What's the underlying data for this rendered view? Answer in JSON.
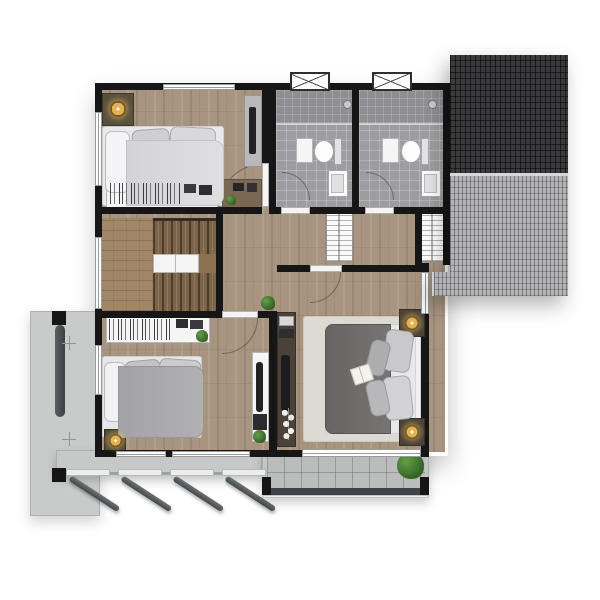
{
  "meta": {
    "type": "architectural-floor-plan",
    "floor": "upper-floor",
    "visible_text": []
  },
  "palette": {
    "wall": "#161616",
    "wood": "#a8947f",
    "bath-tile": "#9d9da1",
    "shower-tile": "#8f8f93",
    "roof-dark": "#3a3a3c",
    "roof-light": "#b2b2b4",
    "concrete": "#c9cbca",
    "balcony-tile": "#babdbc",
    "railing": "#3e4245",
    "stair-wood": "#7c6347",
    "rug": "#dcdad3",
    "duvet-master": "#6f6d6a",
    "duvet-bedroom2": "#ababae",
    "bedding-light": "#e8e8ea",
    "accent-lamp": "#e3b254",
    "plant-green": "#356226"
  },
  "rooms": [
    {
      "id": "bedroom-top-left",
      "furniture": [
        "single-bed",
        "nightstand-with-lamp",
        "dresser-with-books",
        "desk-with-plants",
        "tall-cabinet-with-tv"
      ]
    },
    {
      "id": "bathroom-left",
      "fixtures": [
        "shower-zone",
        "shower-head",
        "toilet",
        "sink",
        "bath-mat",
        "louver-window",
        "door-swing"
      ]
    },
    {
      "id": "bathroom-right",
      "fixtures": [
        "shower-zone",
        "shower-head",
        "toilet",
        "sink",
        "bath-mat",
        "louver-window",
        "door-swing"
      ]
    },
    {
      "id": "staircase",
      "features": [
        "upper-flight",
        "mid-cabinet",
        "lower-flight",
        "side-landing",
        "railing-wall"
      ]
    },
    {
      "id": "hallway",
      "furniture": [
        "wardrobe-closet-left",
        "wardrobe-closet-right"
      ]
    },
    {
      "id": "bedroom-bottom-left",
      "furniture": [
        "double-bed",
        "bookshelf",
        "floor-lamp",
        "tv-console-white",
        "door-swing"
      ]
    },
    {
      "id": "master-bedroom",
      "furniture": [
        "double-bed",
        "area-rug",
        "nightstand-with-lamp-top",
        "nightstand-with-lamp-bottom",
        "tv-console-dark",
        "open-book",
        "door-swing"
      ]
    },
    {
      "id": "balcony",
      "features": [
        "tiled-floor",
        "railing",
        "potted-plant",
        "sliding-glass-door"
      ]
    },
    {
      "id": "side-concrete-slab",
      "features": [
        "support-beam",
        "columns",
        "survey-cross-marks"
      ]
    },
    {
      "id": "front-awning",
      "features": [
        "concrete-band",
        "four-diagonal-struts",
        "mounting-plates"
      ]
    },
    {
      "id": "roof-section",
      "features": [
        "dark-tile-upper",
        "light-tile-lower",
        "light-tile-extension"
      ]
    }
  ]
}
